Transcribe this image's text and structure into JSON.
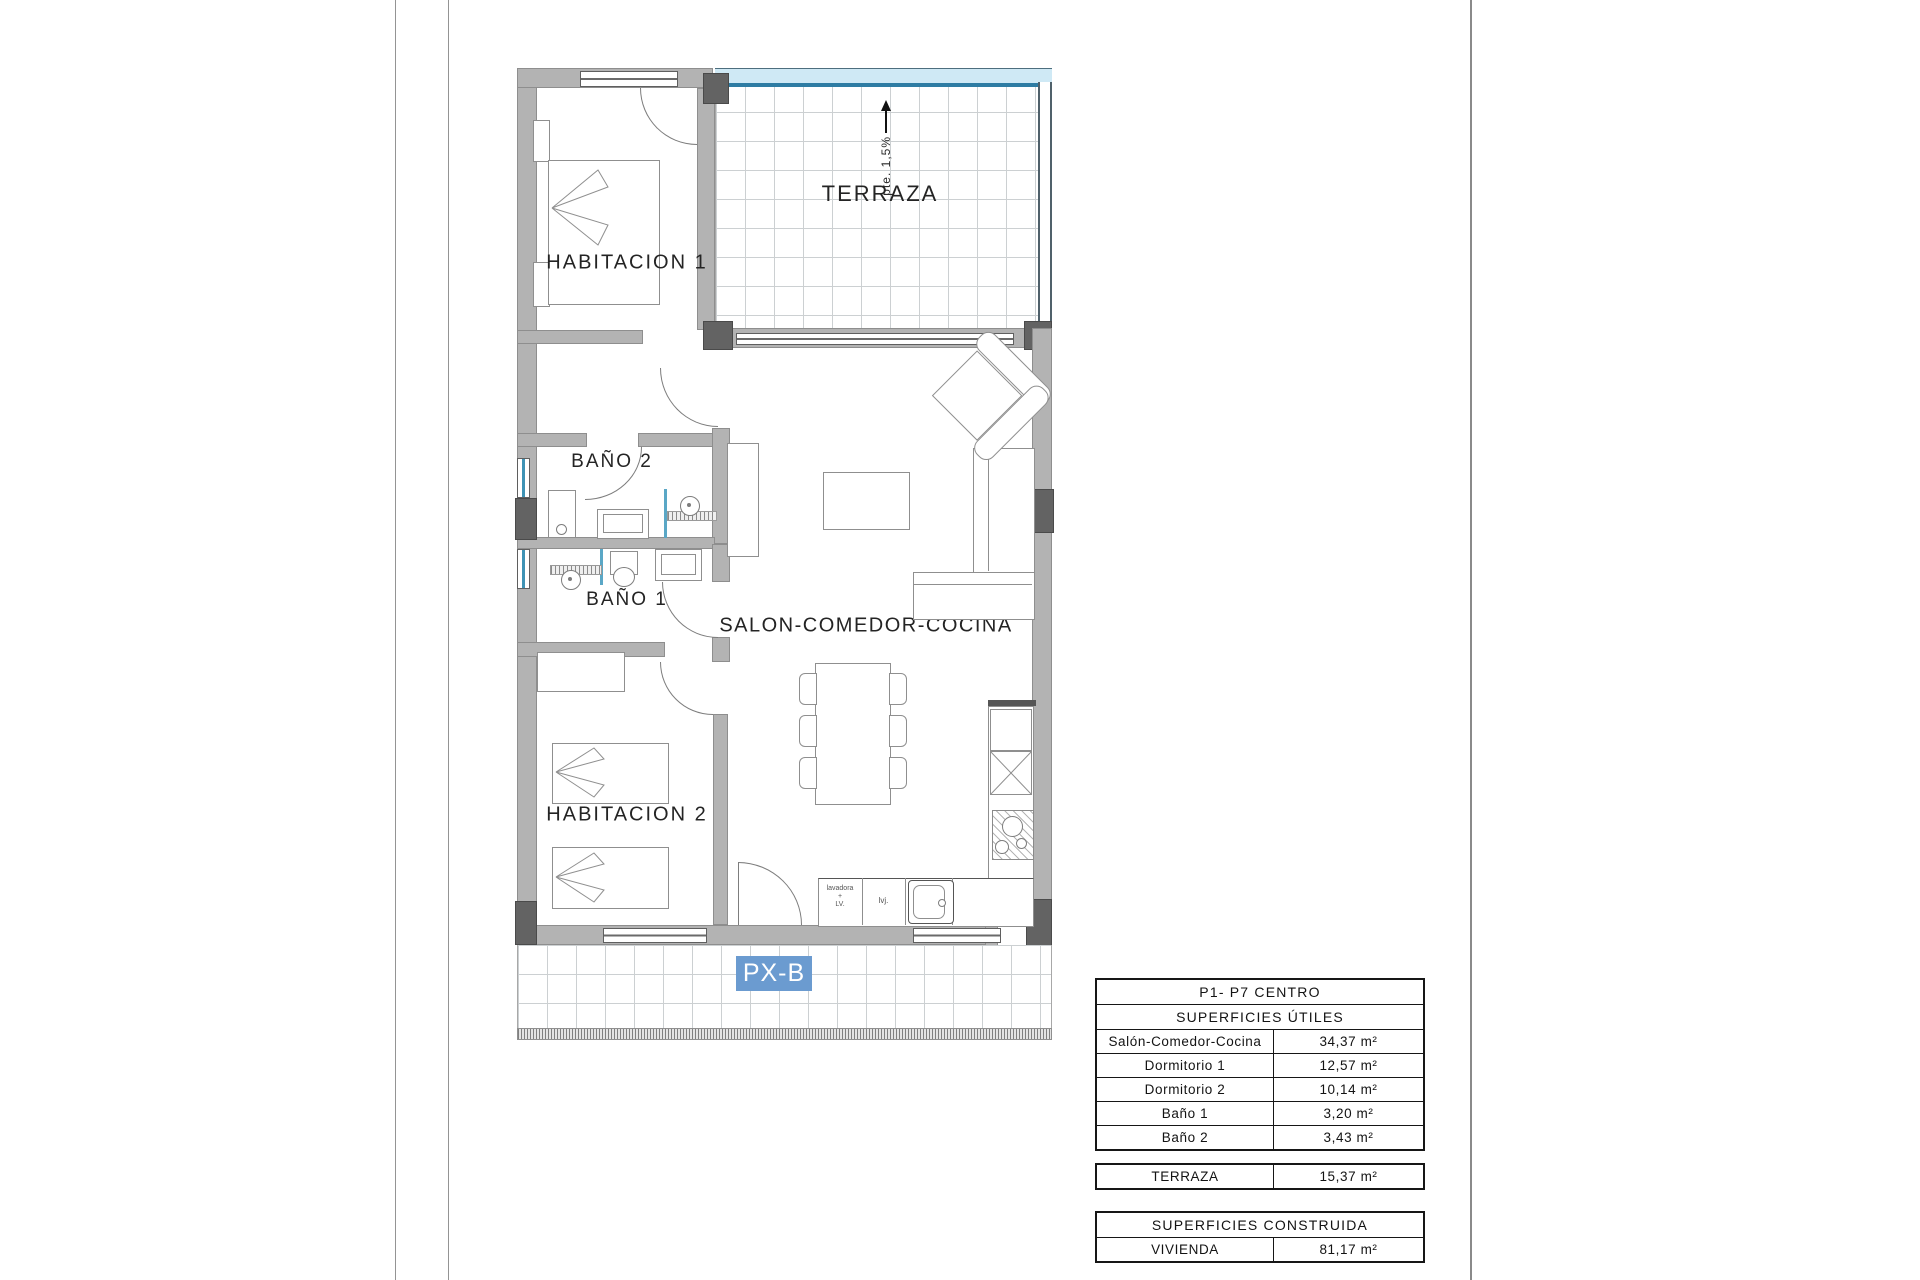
{
  "plan": {
    "labels": {
      "habitacion1": "HABITACION 1",
      "habitacion2": "HABITACION 2",
      "bano1": "BAÑO 1",
      "bano2": "BAÑO 2",
      "terraza": "TERRAZA",
      "salon": "SALON-COMEDOR-COCINA"
    },
    "slope_note": "pte. 1,5%",
    "unit_badge": "PX-B",
    "kitchen": {
      "washer_l1": "lavadora",
      "washer_l2": "+",
      "washer_l3": "LV.",
      "dishwasher": "lvj."
    },
    "colors": {
      "wall_gray": "#b3b3b3",
      "pillar_gray": "#636363",
      "railing_blue": "#2e7ca3",
      "badge_blue": "#6b9bd0"
    }
  },
  "tables": {
    "main": {
      "title": "P1- P7 CENTRO",
      "subtitle": "SUPERFICIES ÚTILES",
      "rows": [
        {
          "label": "Salón-Comedor-Cocina",
          "value": "34,37 m²"
        },
        {
          "label": "Dormitorio 1",
          "value": "12,57 m²"
        },
        {
          "label": "Dormitorio 2",
          "value": "10,14 m²"
        },
        {
          "label": "Baño 1",
          "value": "3,20 m²"
        },
        {
          "label": "Baño 2",
          "value": "3,43 m²"
        }
      ]
    },
    "terraza_row": {
      "label": "TERRAZA",
      "value": "15,37 m²"
    },
    "construida": {
      "title": "SUPERFICIES CONSTRUIDA",
      "rows": [
        {
          "label": "VIVIENDA",
          "value": "81,17 m²"
        }
      ]
    }
  }
}
